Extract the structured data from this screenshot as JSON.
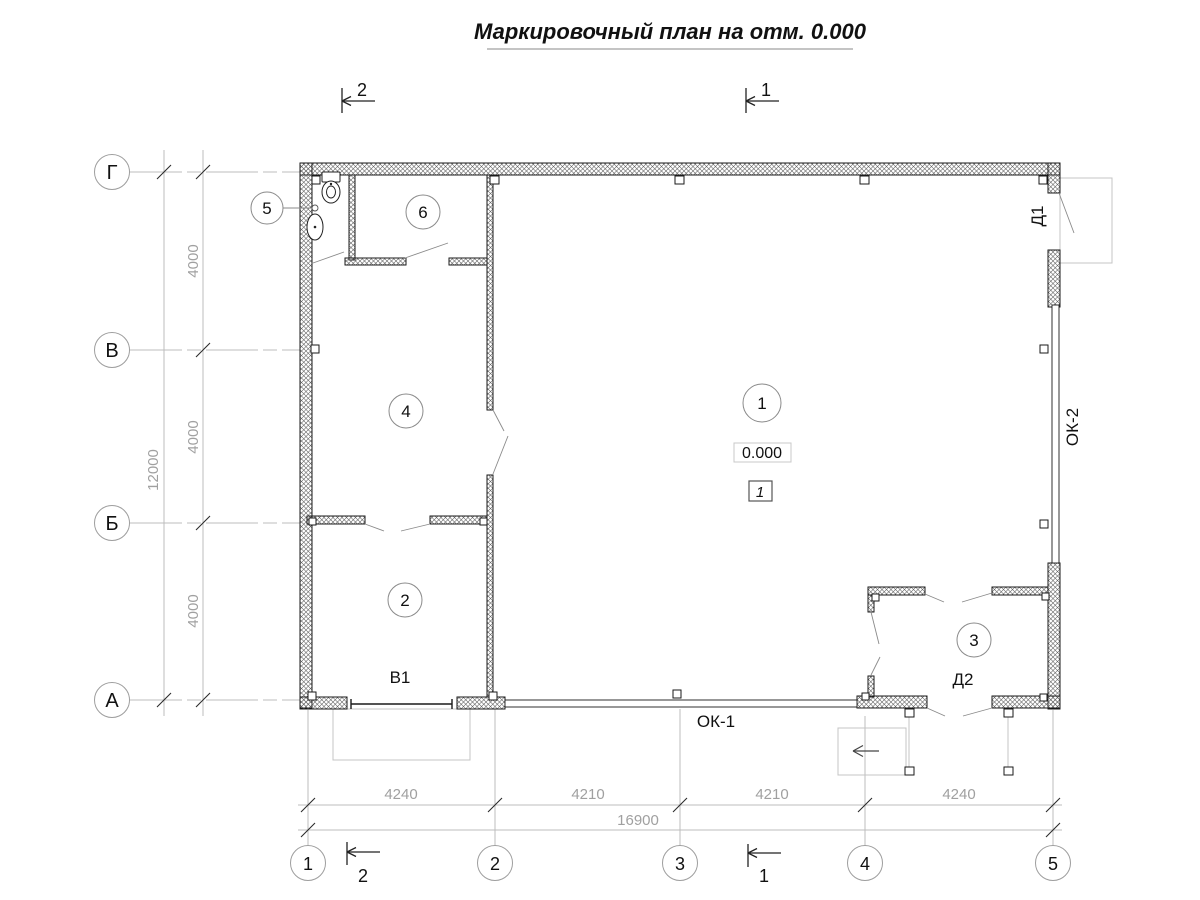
{
  "title": "Маркировочный план на отм. 0.000",
  "grid": {
    "rows": [
      {
        "label": "Г"
      },
      {
        "label": "В"
      },
      {
        "label": "Б"
      },
      {
        "label": "А"
      }
    ],
    "cols": [
      {
        "label": "1"
      },
      {
        "label": "2"
      },
      {
        "label": "3"
      },
      {
        "label": "4"
      },
      {
        "label": "5"
      }
    ]
  },
  "dims": {
    "left": {
      "segments": [
        {
          "value": "4000"
        },
        {
          "value": "4000"
        },
        {
          "value": "4000"
        }
      ],
      "total": "12000"
    },
    "bottom": {
      "segments": [
        {
          "value": "4240"
        },
        {
          "value": "4210"
        },
        {
          "value": "4210"
        },
        {
          "value": "4240"
        }
      ],
      "total": "16900"
    }
  },
  "sections": {
    "top_left": "2",
    "top_right": "1",
    "bottom_left": "2",
    "bottom_right": "1"
  },
  "rooms": [
    {
      "number": "1"
    },
    {
      "number": "2"
    },
    {
      "number": "3"
    },
    {
      "number": "4"
    },
    {
      "number": "5"
    },
    {
      "number": "6"
    }
  ],
  "marks": {
    "elevation": "0.000",
    "floor_type": "1",
    "gate": "В1",
    "window_1": "ОК-1",
    "window_2": "ОК-2",
    "door_1": "Д1",
    "door_2": "Д2"
  },
  "colors": {
    "line": "#1a1a1a",
    "construction": "#bcbcbc",
    "dim_text": "#a0a0a0"
  }
}
